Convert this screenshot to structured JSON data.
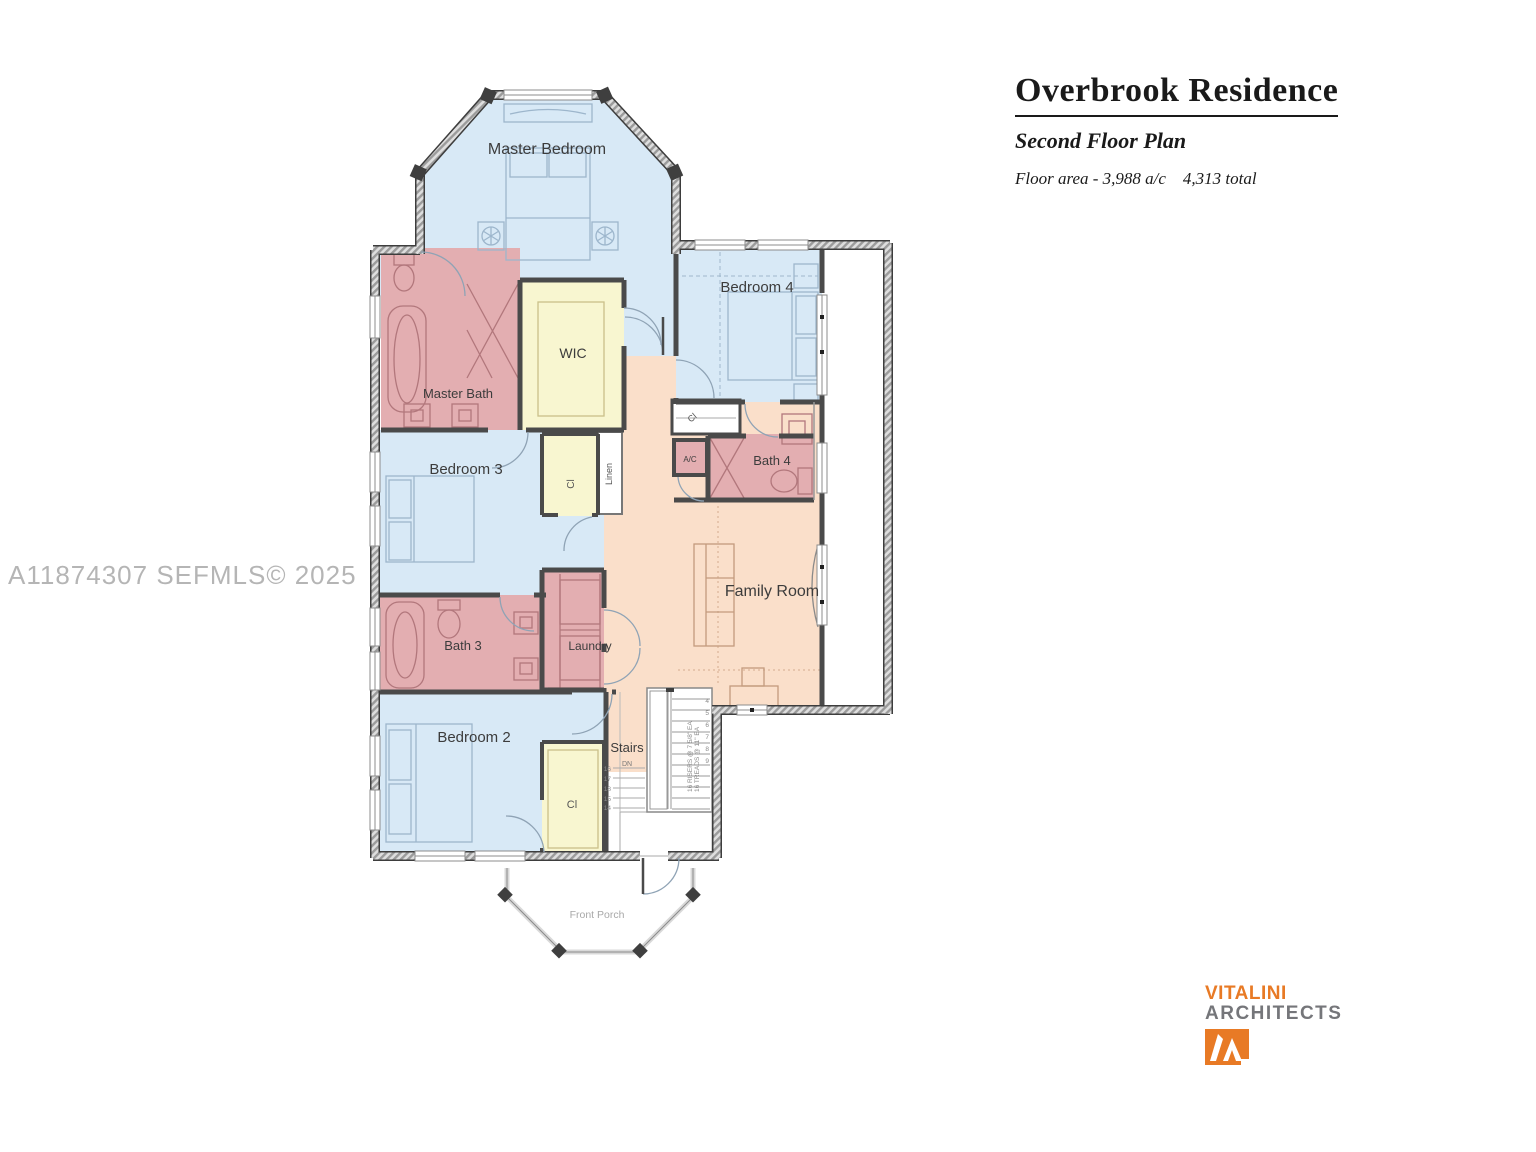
{
  "title_block": {
    "title": "Overbrook Residence",
    "subtitle": "Second Floor Plan",
    "area_note": "Floor area - 3,988 a/c    4,313 total"
  },
  "watermark": "A11874307  SEFMLS© 2025",
  "logo": {
    "name": "VITALINI",
    "type": "ARCHITECTS"
  },
  "labels": {
    "master_bedroom": "Master Bedroom",
    "bedroom_2": "Bedroom 2",
    "bedroom_3": "Bedroom 3",
    "bedroom_4": "Bedroom 4",
    "master_bath": "Master Bath",
    "bath_3": "Bath 3",
    "bath_4": "Bath 4",
    "wic": "WIC",
    "laundry": "Laundry",
    "family_room": "Family Room",
    "stairs": "Stairs",
    "front_porch": "Front Porch",
    "closet": "Cl",
    "linen": "Linen",
    "ac": "A/C",
    "dn": "DN"
  },
  "stairs": {
    "note1": "16 RISERS @ 7 5/8\" EA",
    "note2": "16 TREADS @ 11\" EA",
    "left_numbers": [
      "16",
      "17",
      "18",
      "15",
      "14"
    ],
    "right_numbers": [
      "4",
      "5",
      "6",
      "7",
      "8",
      "9"
    ]
  },
  "colors": {
    "bedroom_fill": "#d8e9f6",
    "bath_fill": "#e3aeb1",
    "closet_fill": "#f8f6d0",
    "hall_fill": "#fadfca",
    "accent_orange": "#e87a25",
    "logo_gray": "#75767a"
  }
}
